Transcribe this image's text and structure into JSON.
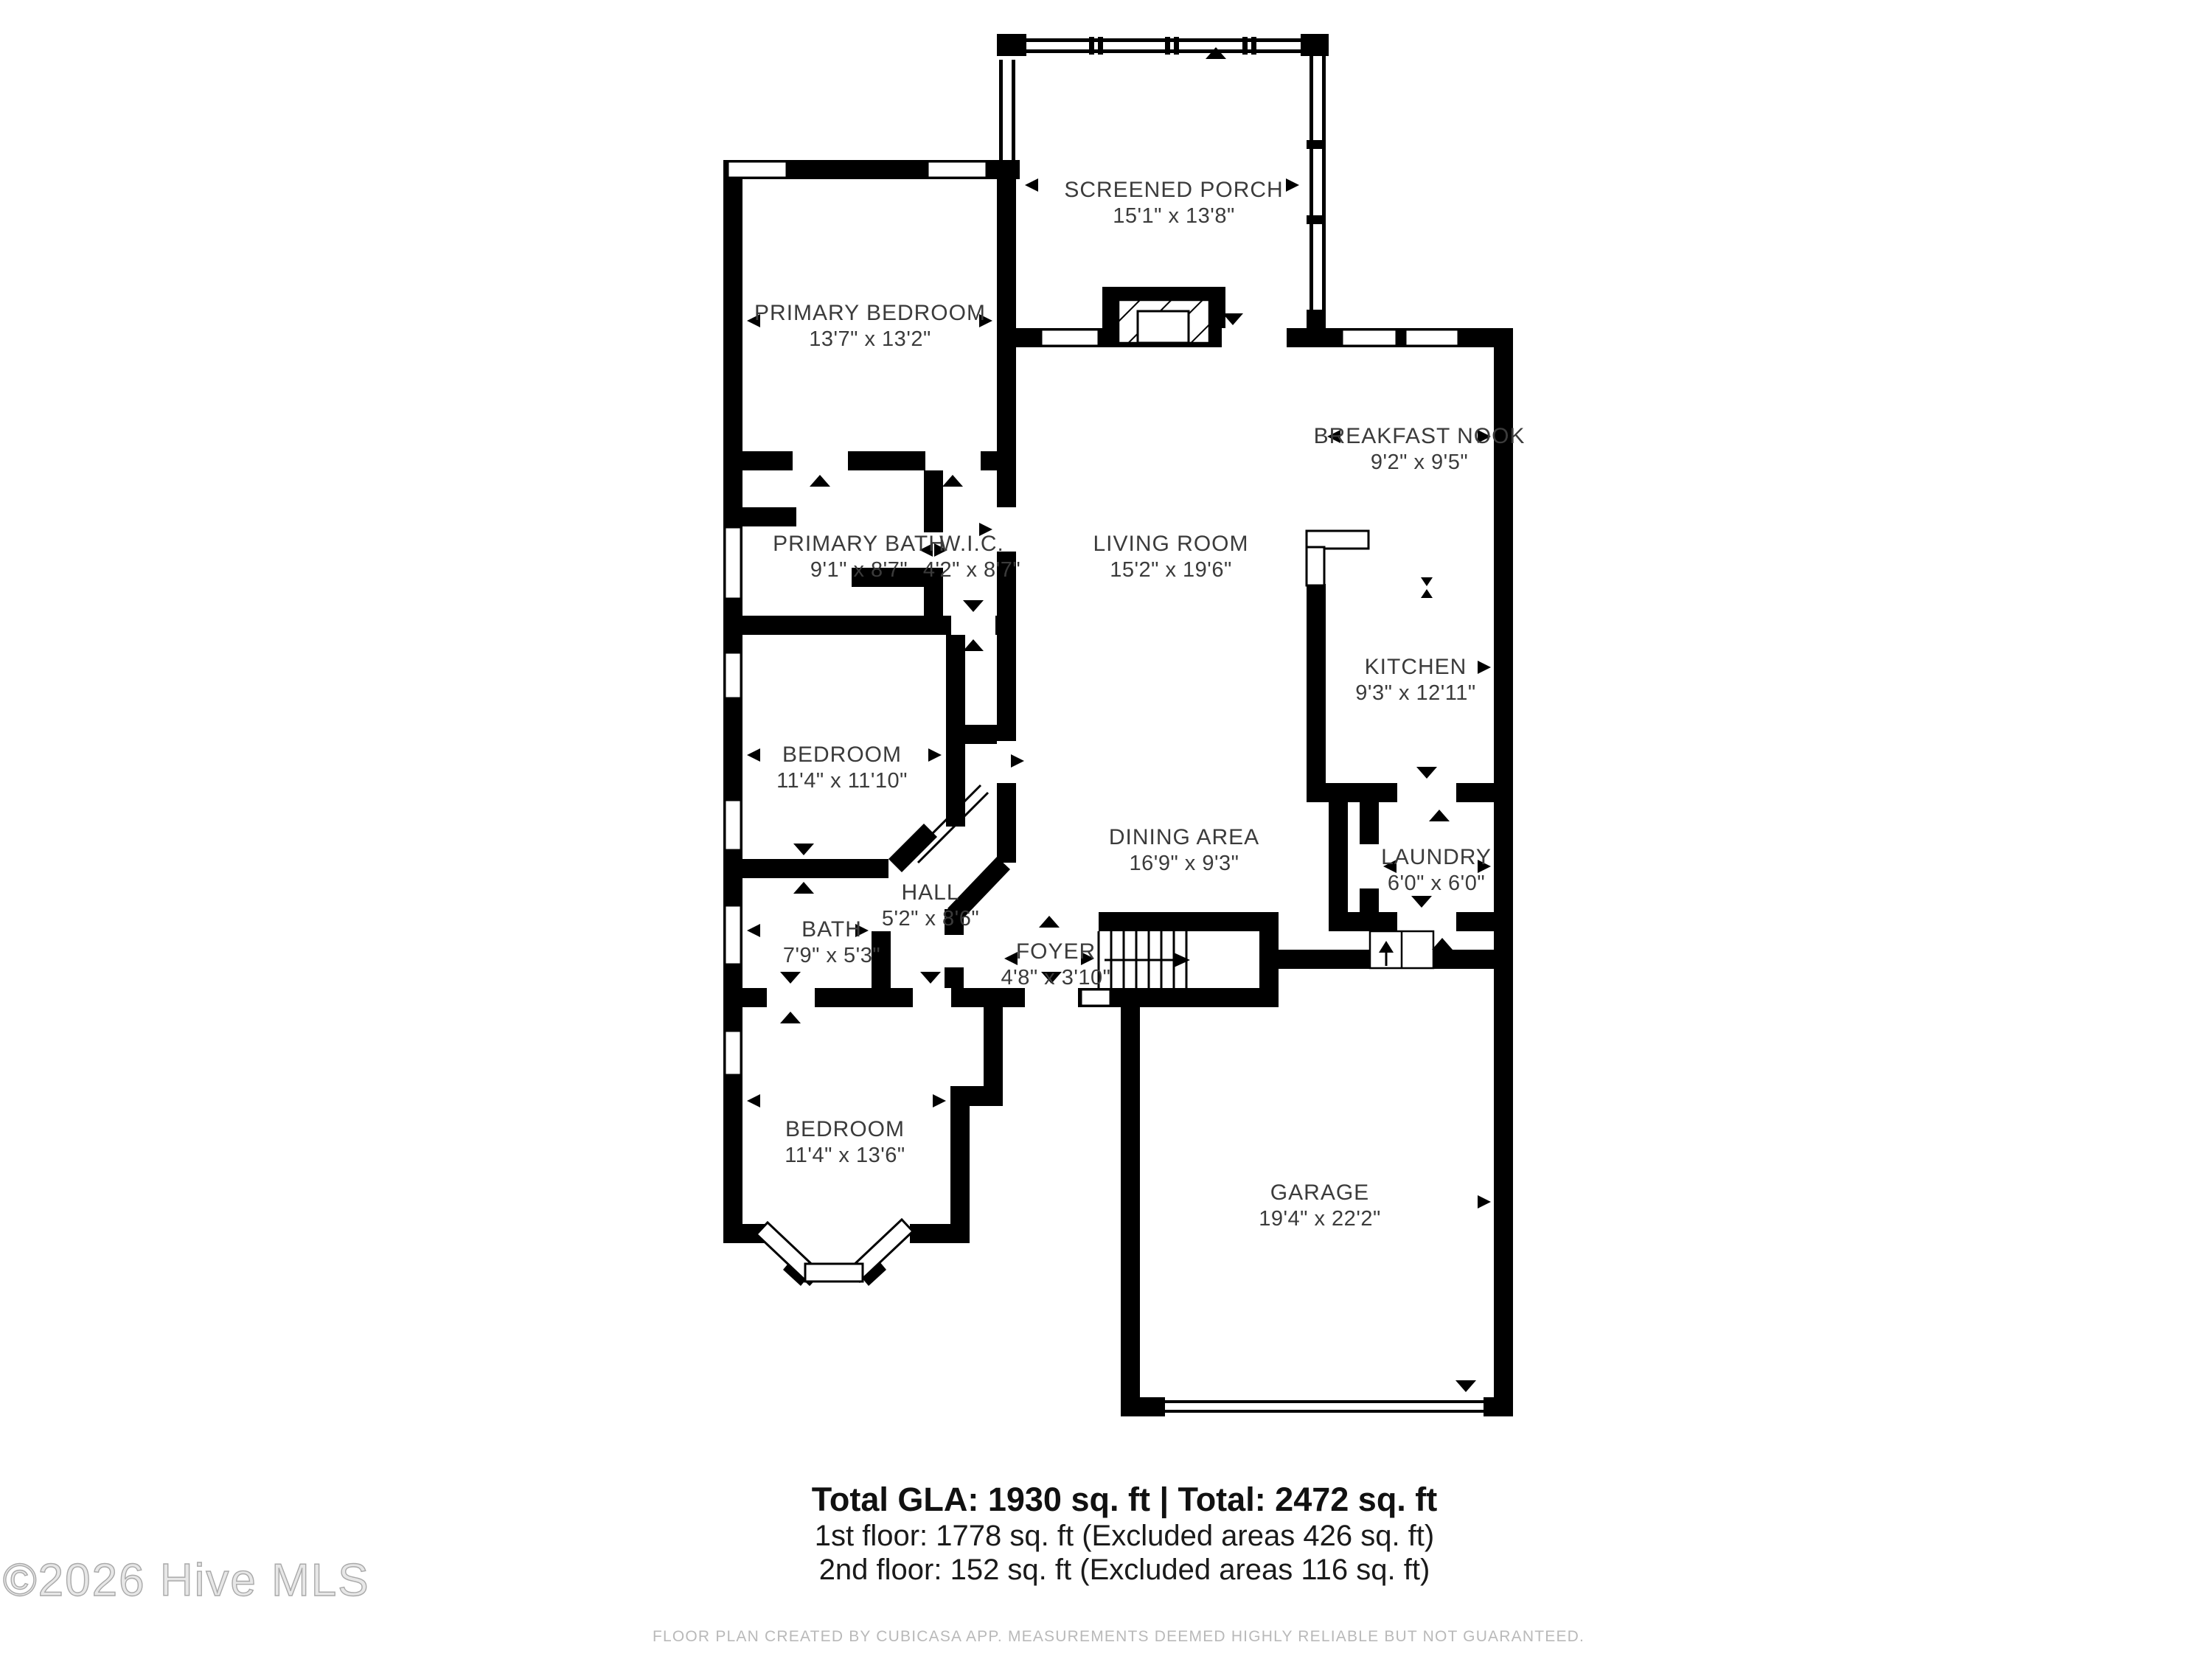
{
  "rooms": {
    "screened_porch": {
      "name": "SCREENED PORCH",
      "dims": "15'1\" x 13'8\""
    },
    "primary_bedroom": {
      "name": "PRIMARY BEDROOM",
      "dims": "13'7\" x 13'2\""
    },
    "primary_bath": {
      "name": "PRIMARY BATH",
      "dims": "9'1\" x 8'7\""
    },
    "wic": {
      "name": "W.I.C.",
      "dims": "4'2\" x 8'7\""
    },
    "living_room": {
      "name": "LIVING ROOM",
      "dims": "15'2\" x 19'6\""
    },
    "breakfast_nook": {
      "name": "BREAKFAST NOOK",
      "dims": "9'2\" x 9'5\""
    },
    "kitchen": {
      "name": "KITCHEN",
      "dims": "9'3\" x 12'11\""
    },
    "bedroom_mid": {
      "name": "BEDROOM",
      "dims": "11'4\" x 11'10\""
    },
    "dining_area": {
      "name": "DINING AREA",
      "dims": "16'9\" x 9'3\""
    },
    "laundry": {
      "name": "LAUNDRY",
      "dims": "6'0\" x 6'0\""
    },
    "hall": {
      "name": "HALL",
      "dims": "5'2\" x 8'6\""
    },
    "bath": {
      "name": "BATH",
      "dims": "7'9\" x 5'3\""
    },
    "foyer": {
      "name": "FOYER",
      "dims": "4'8\" x 3'10\""
    },
    "bedroom_bottom": {
      "name": "BEDROOM",
      "dims": "11'4\" x 13'6\""
    },
    "garage": {
      "name": "GARAGE",
      "dims": "19'4\" x 22'2\""
    }
  },
  "footer": {
    "totals_line": "Total GLA: 1930 sq. ft | Total: 2472 sq. ft",
    "first_floor_line": "1st floor: 1778 sq. ft (Excluded areas 426 sq. ft)",
    "second_floor_line": "2nd floor: 152 sq. ft (Excluded areas 116 sq. ft)",
    "watermark": "©2026 Hive MLS",
    "disclaimer": "FLOOR PLAN CREATED BY CUBICASA APP. MEASUREMENTS DEEMED HIGHLY RELIABLE BUT NOT GUARANTEED."
  },
  "colors": {
    "wall": "#000000",
    "label": "#3b3b3b",
    "watermark": "#bdbdbd",
    "disclaimer": "#b9b9b9"
  }
}
